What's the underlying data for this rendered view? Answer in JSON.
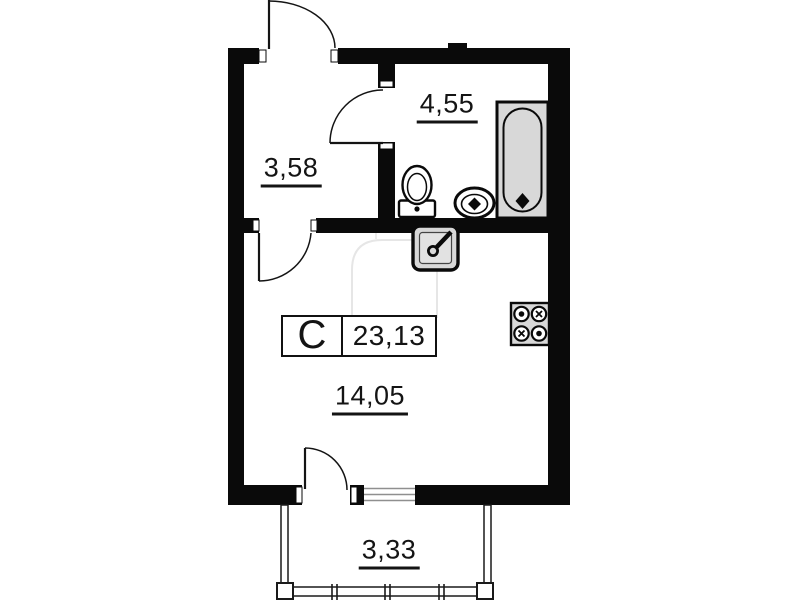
{
  "title": "Studio apartment floor plan",
  "unit": {
    "letter": "C",
    "area": "23,13"
  },
  "rooms": {
    "hallway": {
      "area": "3,58"
    },
    "bathroom": {
      "area": "4,55"
    },
    "living_room": {
      "area": "14,05"
    },
    "balcony": {
      "area": "3,33"
    }
  },
  "fixtures": [
    {
      "icon": "bathtub-icon",
      "room": "bathroom"
    },
    {
      "icon": "toilet-icon",
      "room": "bathroom"
    },
    {
      "icon": "washbasin-icon",
      "room": "bathroom"
    },
    {
      "icon": "kitchen-sink-icon",
      "room": "living_room"
    },
    {
      "icon": "stove-icon",
      "room": "living_room"
    }
  ],
  "colors": {
    "wall": "#0a0a0a",
    "line": "#141414",
    "fixture_fill": "#d8d8d8",
    "window_line": "#8f8f8f",
    "watermark": "#e6e6e6"
  }
}
